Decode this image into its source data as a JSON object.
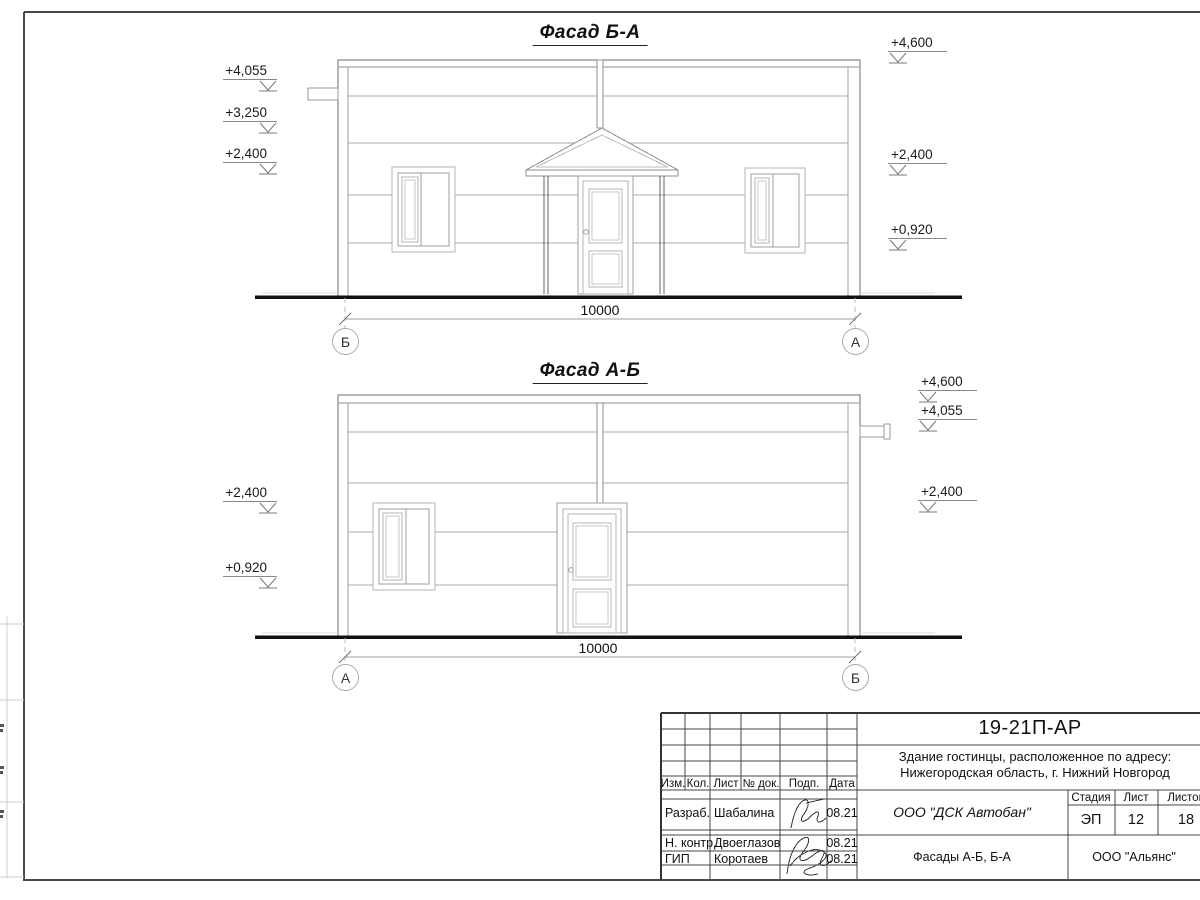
{
  "palette": {
    "ink": "#1a1a1a",
    "line_light": "#a9a9a9",
    "line_dark": "#555555"
  },
  "facade_top": {
    "title": "Фасад Б-А",
    "marks_left": [
      "+4,055",
      "+3,250",
      "+2,400"
    ],
    "marks_right": [
      "+4,600",
      "+2,400",
      "+0,920"
    ],
    "dimension": "10000",
    "axis_left": "Б",
    "axis_right": "А"
  },
  "facade_bottom": {
    "title": "Фасад А-Б",
    "marks_left": [
      "+2,400",
      "+0,920"
    ],
    "marks_right": [
      "+4,600",
      "+4,055",
      "+2,400"
    ],
    "dimension": "10000",
    "axis_left": "А",
    "axis_right": "Б"
  },
  "title_block": {
    "doc_code": "19-21П-АР",
    "address1": "Здание гостинцы, расположенное по адресу:",
    "address2": "Нижегородская область, г. Нижний Новгород",
    "cols": {
      "izm": "Изм.",
      "kol": "Кол.",
      "list": "Лист",
      "doc": "№ док.",
      "podp": "Подп.",
      "data": "Дата"
    },
    "sign_rows": [
      {
        "role": "Разраб.",
        "name": "Шабалина",
        "date": "08.21"
      },
      {
        "role": "Н. контр.",
        "name": "Двоеглазов",
        "date": "08.21"
      },
      {
        "role": "ГИП",
        "name": "Коротаев",
        "date": "08.21"
      }
    ],
    "org": "ООО \"ДСК Автобан\"",
    "drawing_title": "Фасады А-Б, Б-А",
    "client": "ООО \"Альянс\"",
    "stage_label": "Стадия",
    "stage_value": "ЭП",
    "list_label": "Лист",
    "list_value": "12",
    "listov_label": "Листов",
    "listov_value": "18"
  }
}
